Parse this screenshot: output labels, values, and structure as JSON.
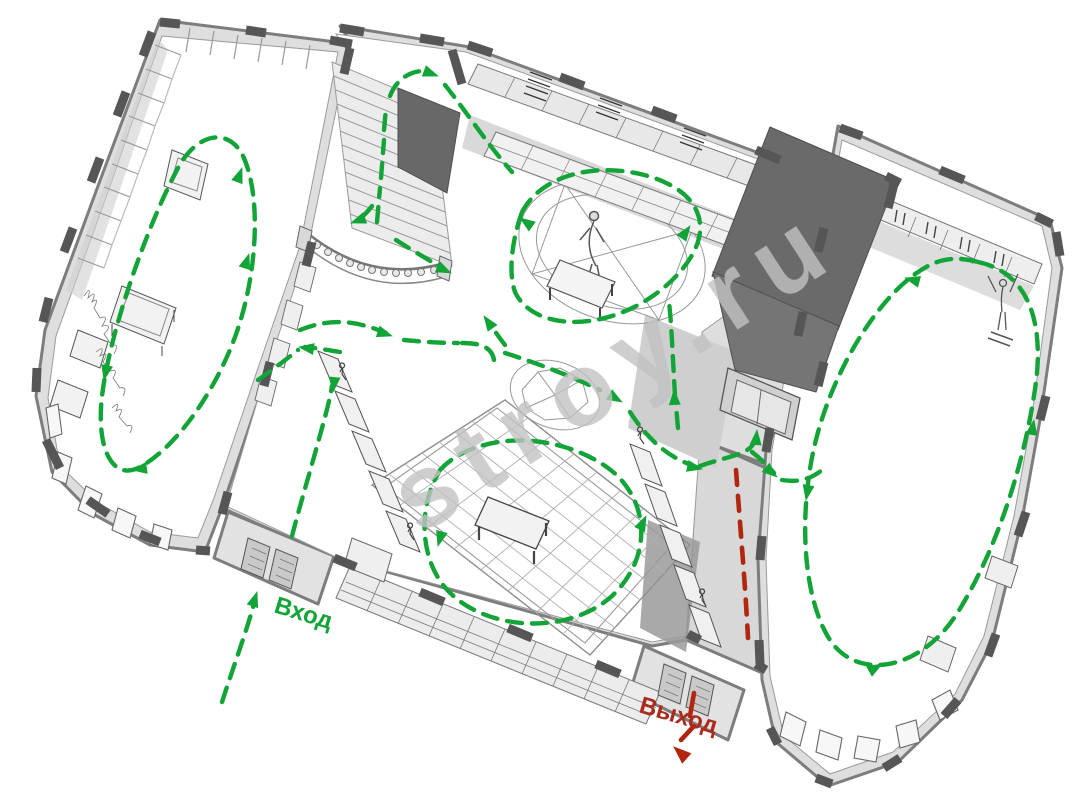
{
  "scene": {
    "type": "museum-floor-plan-3d-cutaway",
    "view": "isometric perspective",
    "background": "#ffffff"
  },
  "labels": {
    "entrance": {
      "text": "Вход",
      "color": "#12a437"
    },
    "exit": {
      "text": "Выход",
      "color": "#ab2a1c"
    }
  },
  "watermark": {
    "text": "stroy.ru",
    "color": "#c2c2c2"
  },
  "palette": {
    "route_green": "#12a437",
    "route_red": "#b0260f",
    "wall_dark": "#565656",
    "wall_mid": "#7d7d7d",
    "slab_dark": "#6a6a6a",
    "plate_gray": "#dedede",
    "shadow_gray": "#cfcfcf",
    "line_gray": "#9a9a9a"
  },
  "icons": {
    "route_arrow": "triangle-arrowhead",
    "entrance_arrow": "dashed-arrow-up",
    "exit_arrow": "dashed-arrow-down"
  }
}
